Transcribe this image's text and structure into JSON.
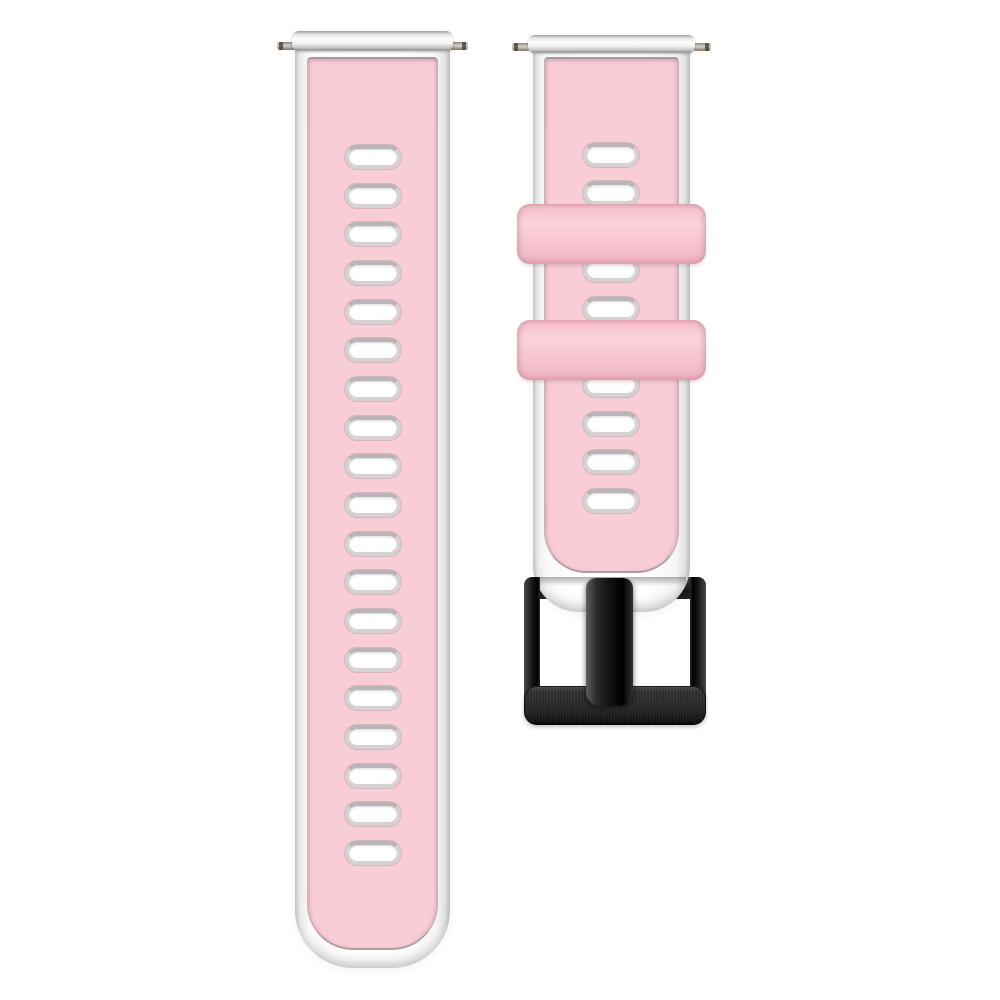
{
  "scene": {
    "type": "product-photo",
    "subject": "Two-tone quick-release silicone watch band, pink top layer over white base, with black pin buckle",
    "background": "#ffffff"
  },
  "colors": {
    "background": "#ffffff",
    "strap_pink": "#f8cdd5",
    "keeper_pink": "#f8c9d3",
    "inlay_seam": "#a49ca1",
    "strap_white": "#fdfdfd",
    "edge_gray": "#c9c9c9",
    "hole_ring": "#d6d2d4",
    "hole_ring_dark": "#b9b4b7",
    "pin_metal": "#cfc8c0",
    "buckle_black": "#1c1c1c"
  },
  "left_strap": {
    "label": "long tail strap with adjustment holes",
    "spring_bar_pins": 2,
    "holes": {
      "count": 19,
      "left": 50,
      "start_top": 113,
      "spacing": 38.67,
      "width": 56,
      "height": 24
    }
  },
  "right_strap": {
    "label": "buckle-side strap",
    "spring_bar_pins": 2,
    "holes": {
      "count": 10,
      "left": 50,
      "start_top": 107,
      "spacing": 38.4,
      "width": 56,
      "height": 24
    },
    "keepers": {
      "count": 2,
      "label": "silicone keeper loops"
    },
    "buckle": {
      "label": "pin buckle",
      "finish": "brushed black metal"
    }
  }
}
